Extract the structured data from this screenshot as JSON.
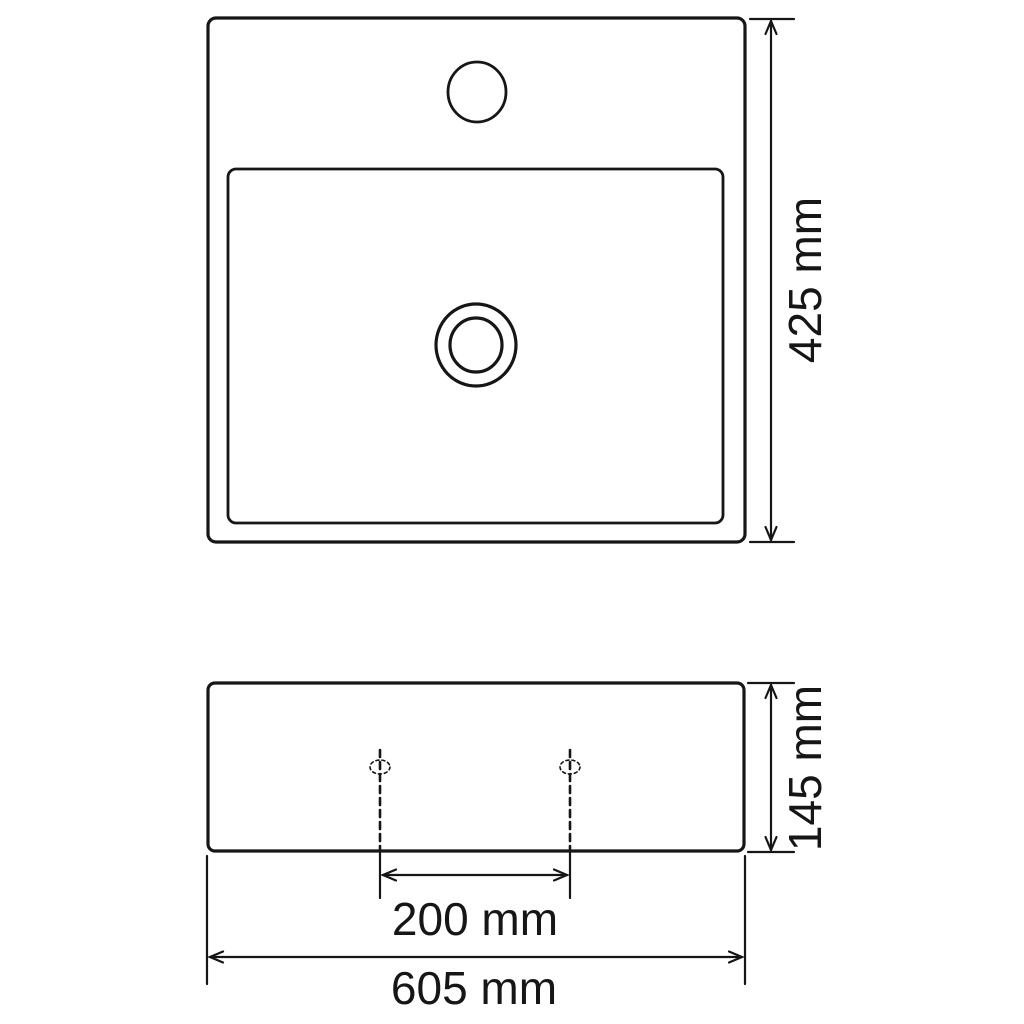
{
  "colors": {
    "background": "#ffffff",
    "line": "#161616"
  },
  "labels": {
    "top_view_depth": "425 mm",
    "front_view_height": "145 mm",
    "front_view_hole_spacing": "200 mm",
    "front_view_width": "605 mm"
  },
  "values_mm": {
    "depth": 425,
    "height": 145,
    "hole_spacing": 200,
    "width": 605
  }
}
